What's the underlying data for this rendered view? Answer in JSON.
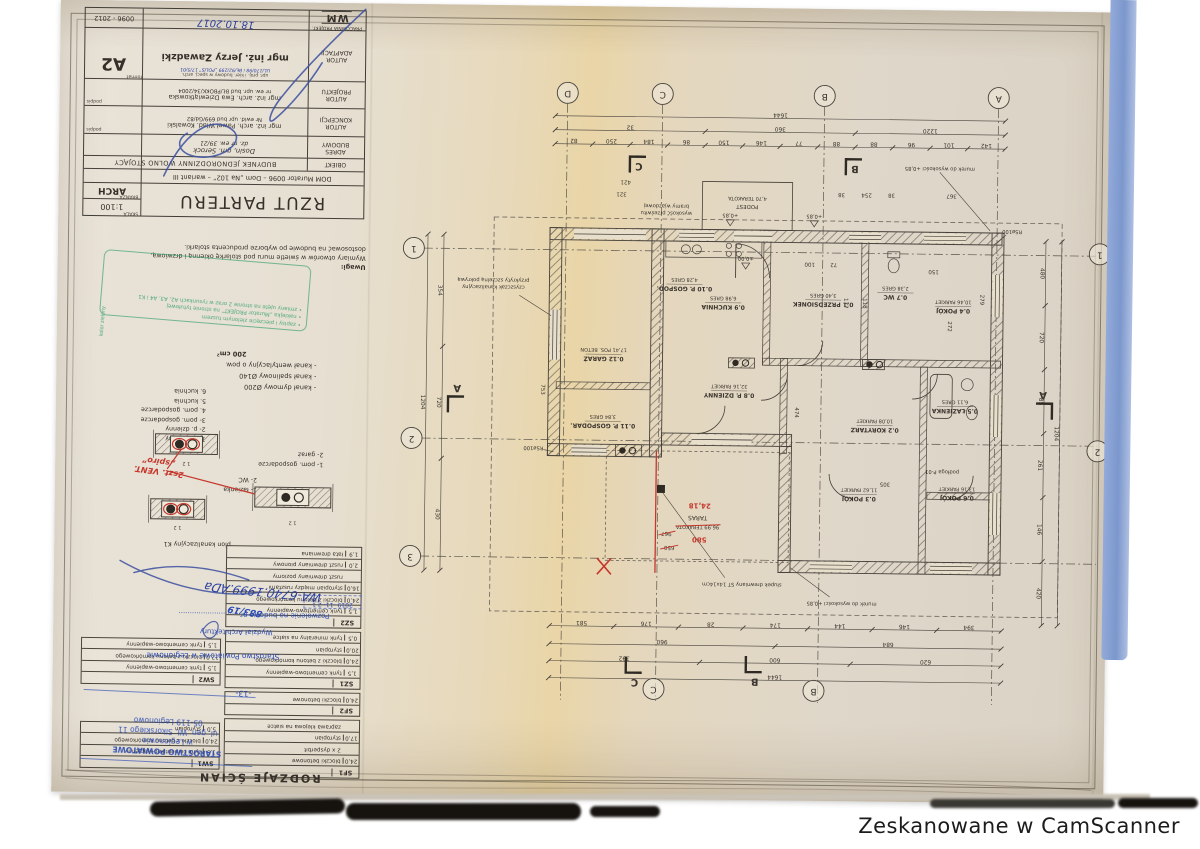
{
  "page": {
    "credit": "Zeskanowane w CamScanner"
  },
  "title_block": {
    "doc_no": "0096 - 2012",
    "format_label": "format",
    "format": "A2",
    "handwritten_date": "18.10.2017",
    "studio_label": "PRACOWNIA PROJEKT.",
    "studio_logo": "WM",
    "adaptation_label": "AUTOR ADAPTACJI",
    "adaptation_note": "upr. proj. i kier. budowy w specj. arch.",
    "adaptation_stamp": "UL/170/98 i BŁ/92/299 „POLIS” 17/5/01",
    "adaptation_name": "mgr inż. Jerzy Zawadzki",
    "design_label": "AUTOR PROJEKTU",
    "design_name": "mgr inż. arch. Ewa Dziewiątkowska",
    "design_no": "nr ew. upr. bud BŁ/PBOKK/34/2004",
    "concept_label": "AUTOR KONCEPCJI",
    "concept_name": "mgr inż. arch. Paweł Wlad. Kowalski",
    "concept_no": "Nr ewid. upr bud 699/Gd/82",
    "address_label": "ADRES BUDOWY",
    "address_line1": "Dosin, gm. Serock",
    "address_line2": "dz. nr ew. 39/21",
    "object_label": "OBIEKT",
    "object_value": "BUDYNEK JEDNORODZINNY WOLNO STOJĄCY",
    "series_line": "DOM Murator 0096 – Dom „Na 102” – wariant III",
    "scale_label": "SKALA",
    "scale": "1:100",
    "branch_label": "BRANŻA",
    "branch": "ARCH",
    "drawing_title": "RZUT PARTERU",
    "podpis": "podpis"
  },
  "notes": {
    "uwagi_label": "Uwagi:",
    "uwagi_line1": "Wymiary otworów w świetle muru pod stolarkę okienną i drzwiową,",
    "uwagi_line2": "dostosować na budowie po wyborze producenta stolarki.",
    "duct_lines": [
      "- kanał dymowy Ø200",
      "- kanał spalinowy Ø140",
      "- kanał wentylacyjny o pow."
    ],
    "duct_area": "200 cm²"
  },
  "green_stamp": {
    "side_text": "kolor zielony",
    "lines": [
      "zapisy i pieczęcie zielonym tuszem",
      "naklejka „Murator PROJEKT” na stronie tytułowej",
      "zmiany ujęte na stronie 2 oraz w rysunkach A2, A3, A4 i K1"
    ]
  },
  "legend": {
    "numbered_rooms": [
      "1- p. dzienny",
      "2- p. dzienny",
      "3- pom. gospodarcze",
      "4. pom. gospodarcze",
      "5. kuchnia",
      "6. kuchnia"
    ],
    "aux_rooms": [
      "1- pom. gospodarcze",
      "2- garaż"
    ],
    "bath_rooms": [
      "1- łazienka",
      "2- WC"
    ],
    "pion_label": "pion kanalizacyjny K1",
    "red_note_line1": "2szt. VENT.",
    "red_note_line2": "„spiro”"
  },
  "walls_table": {
    "header": "RODZAJE ŚCIAN",
    "right_groups": [
      {
        "code": "SF1",
        "layers": [
          [
            "24,0",
            "bloczki betonowe"
          ],
          [
            "",
            "2 x dysperbit"
          ],
          [
            "17,0",
            "styropian"
          ],
          [
            "",
            "zaprawa klejowa na siatce"
          ]
        ]
      },
      {
        "code": "SF2",
        "layers": [
          [
            "24,0",
            "bloczki betonowe"
          ]
        ]
      },
      {
        "code": "SZ1",
        "layers": [
          [
            "1,5",
            "tynk cementowo-wapienny"
          ],
          [
            "24,0",
            "bloczki z betonu komórkowego"
          ],
          [
            "20,0",
            "styropian"
          ],
          [
            "0,5",
            "tynk mineralny na siatce"
          ]
        ]
      },
      {
        "code": "SZ2",
        "layers": [
          [
            "1,5",
            "tynk cementowo-wapienny"
          ],
          [
            "24,0",
            "bloczki z betonu komórkowego"
          ],
          [
            "16,0",
            "styropian między rusztami"
          ],
          [
            "",
            "ruszt drewniany poziomy"
          ],
          [
            "2,0",
            "ruszt drewniany pionowy"
          ],
          [
            "1,9",
            "łata drewniana"
          ]
        ]
      }
    ],
    "left_groups": [
      {
        "code": "SW1",
        "layers": [
          [
            "1,5",
            "tynk cementowo-wapienny"
          ],
          [
            "24,0",
            "bloczki z betonu komórkowego"
          ],
          [
            "5,0",
            "styropian"
          ]
        ]
      },
      {
        "code": "SW2",
        "layers": [
          [
            "1,5",
            "tynk cementowo-wapienny"
          ],
          [
            "12,0",
            "bloczki z betonu komórkowego"
          ],
          [
            "1,5",
            "tynk cementowo-wapienny"
          ]
        ]
      }
    ]
  },
  "blue_stamps": {
    "permit_label": "Pozwolenie na budowę nr.",
    "permit_no": "883/19",
    "permit_date": "2019 -11- 2 1",
    "permit_ref": "WA-6740.1999.ADa",
    "office_line1": "Wydział Architektury",
    "office_line2": "Starostwo Powiatowe w Legionowie",
    "office_stamp": [
      "STAROSTWO POWIATOWE",
      "w Legionowie",
      "ul. gen. Wł. Sikorskiego 11",
      "05-119 Legionowo"
    ],
    "page_mark": "-13-"
  },
  "plan": {
    "grid_top": [
      "D",
      "C",
      "B",
      "A"
    ],
    "grid_left": [
      "1",
      "2",
      "3"
    ],
    "grid_right": [
      "1",
      "2"
    ],
    "grid_bottom": [
      "C",
      "B"
    ],
    "rooms": [
      {
        "no": "0.1",
        "name": "PRZEDSIONEK",
        "area": "3,40",
        "floor": "GRES"
      },
      {
        "no": "0.2",
        "name": "KORYTARZ",
        "area": "10,08",
        "floor": "PARKIET"
      },
      {
        "no": "0.3",
        "name": "POKÓJ",
        "area": "11,62",
        "floor": "PARKIET"
      },
      {
        "no": "0.4",
        "name": "POKÓJ",
        "area": "10,46",
        "floor": "PARKIET"
      },
      {
        "no": "0.5",
        "name": "ŁAZIENKA",
        "area": "6,11",
        "floor": "GRES"
      },
      {
        "no": "0.6",
        "name": "POKÓJ",
        "area": "13,16",
        "floor": "PARKIET"
      },
      {
        "no": "0.7",
        "name": "WC",
        "area": "2,38",
        "floor": "GRES"
      },
      {
        "no": "0.8",
        "name": "P. DZIENNY",
        "area": "32,16",
        "floor": "PARKIET"
      },
      {
        "no": "0.9",
        "name": "KUCHNIA",
        "area": "6,98",
        "floor": "GRES"
      },
      {
        "no": "0.10",
        "name": "P. GOSPOD.",
        "area": "4,28",
        "floor": "GRES"
      },
      {
        "no": "0.11",
        "name": "P. GOSPODAR.",
        "area": "3,84",
        "floor": "GRES"
      },
      {
        "no": "0.12",
        "name": "GARAŻ",
        "area": "17,41",
        "floor": "POS. BETON"
      }
    ],
    "terrace": {
      "label": "TARAS",
      "finish": "TERAKOTA",
      "area_crossed": "96,99",
      "area_red": "24,18",
      "dim_red": "580",
      "dims_crossed": [
        "967",
        "650"
      ]
    },
    "podest": {
      "label": "PODEST",
      "area": "4,70",
      "finish": "TERAKOTA"
    },
    "dims_top": [
      [
        "1644"
      ],
      [
        "32",
        "360",
        "1220"
      ],
      [
        "82",
        "250",
        "184",
        "86",
        "150",
        "146",
        "77",
        "88",
        "88",
        "96",
        "101",
        "142"
      ]
    ],
    "dims_bottom": [
      [
        "581",
        "176",
        "28",
        "174",
        "144",
        "146",
        "394"
      ],
      [
        "960",
        "684"
      ],
      [
        "392",
        "600",
        "620"
      ],
      [
        "1644"
      ]
    ],
    "dims_left": [
      [
        "354",
        "720",
        "430"
      ],
      [
        "1204"
      ]
    ],
    "dims_right": [
      [
        "480",
        "720",
        "85",
        "261",
        "146",
        "420"
      ],
      [
        "1204"
      ]
    ],
    "dims_misc": [
      "38",
      "254",
      "38",
      "367",
      "421",
      "321",
      "474",
      "279",
      "272",
      "150",
      "100",
      "72",
      "177",
      "118",
      "305",
      "753"
    ],
    "annotations": [
      [
        "murek do wysokości +0,85"
      ],
      [
        "murek do wysokości +0,85"
      ],
      [
        "słupek drewniany ST 14x14cm"
      ],
      [
        "czyszczak kanalizacyjny",
        "przykryty szczelną pokrywą"
      ],
      [
        "wysokość prześwitu",
        "bramy wjazdowej"
      ],
      [
        "RSø100"
      ],
      [
        "RSø100"
      ],
      [
        "podłoga P-01"
      ],
      [
        "±0,00"
      ],
      [
        "+0,85"
      ],
      [
        "+0,85"
      ]
    ],
    "section_marks": [
      "C",
      "B",
      "C",
      "B",
      "A",
      "A"
    ]
  }
}
